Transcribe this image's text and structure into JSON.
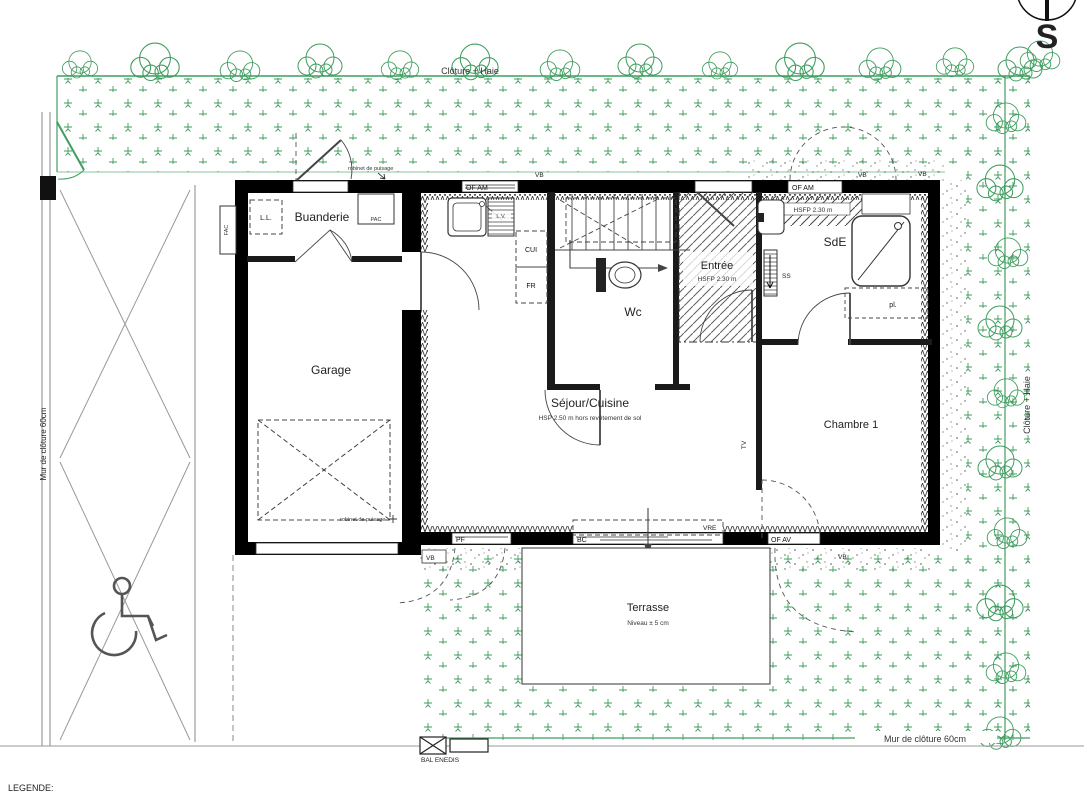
{
  "colors": {
    "vegetation": "#3f9e5f",
    "walls": "#000000",
    "lines": "#555555"
  },
  "compass": {
    "south": "S"
  },
  "site": {
    "cloture_haie_top": "Clôture + Haie",
    "cloture_haie_right": "Clôture + Haie",
    "mur_cloture_left": "Mur de clôture 60cm",
    "mur_cloture_bottom": "Mur de clôture 60cm",
    "bal_enedis": "BAL ENEDIS",
    "legend": "LEGENDE:"
  },
  "rooms": {
    "buanderie": {
      "label": "Buanderie"
    },
    "garage": {
      "label": "Garage"
    },
    "sejour": {
      "label": "Séjour/Cuisine",
      "note": "HSP 2.50 m hors revêtement de sol"
    },
    "wc": {
      "label": "Wc"
    },
    "entree": {
      "label": "Entrée",
      "note": "HSFP 2.30 m"
    },
    "sde": {
      "label": "SdE",
      "note": "HSFP 2.30 m"
    },
    "chambre1": {
      "label": "Chambre 1"
    },
    "terrasse": {
      "label": "Terrasse",
      "note": "Niveau ± 5 cm"
    }
  },
  "equipment": {
    "lave_linge": "L.L.",
    "pac": "PAC",
    "fac": "FAC",
    "cuisine": "CUI",
    "frigo": "FR",
    "lave_vaisselle": "L.V.",
    "seche_serviettes": "SS",
    "tv": "TV",
    "placard": "pl.",
    "robinet": "robinet de puisage"
  },
  "openings": {
    "of_am": "OF AM",
    "of_av": "OF AV",
    "pf": "PF",
    "bc": "BC",
    "vre": "VRE",
    "vb": "VB"
  }
}
